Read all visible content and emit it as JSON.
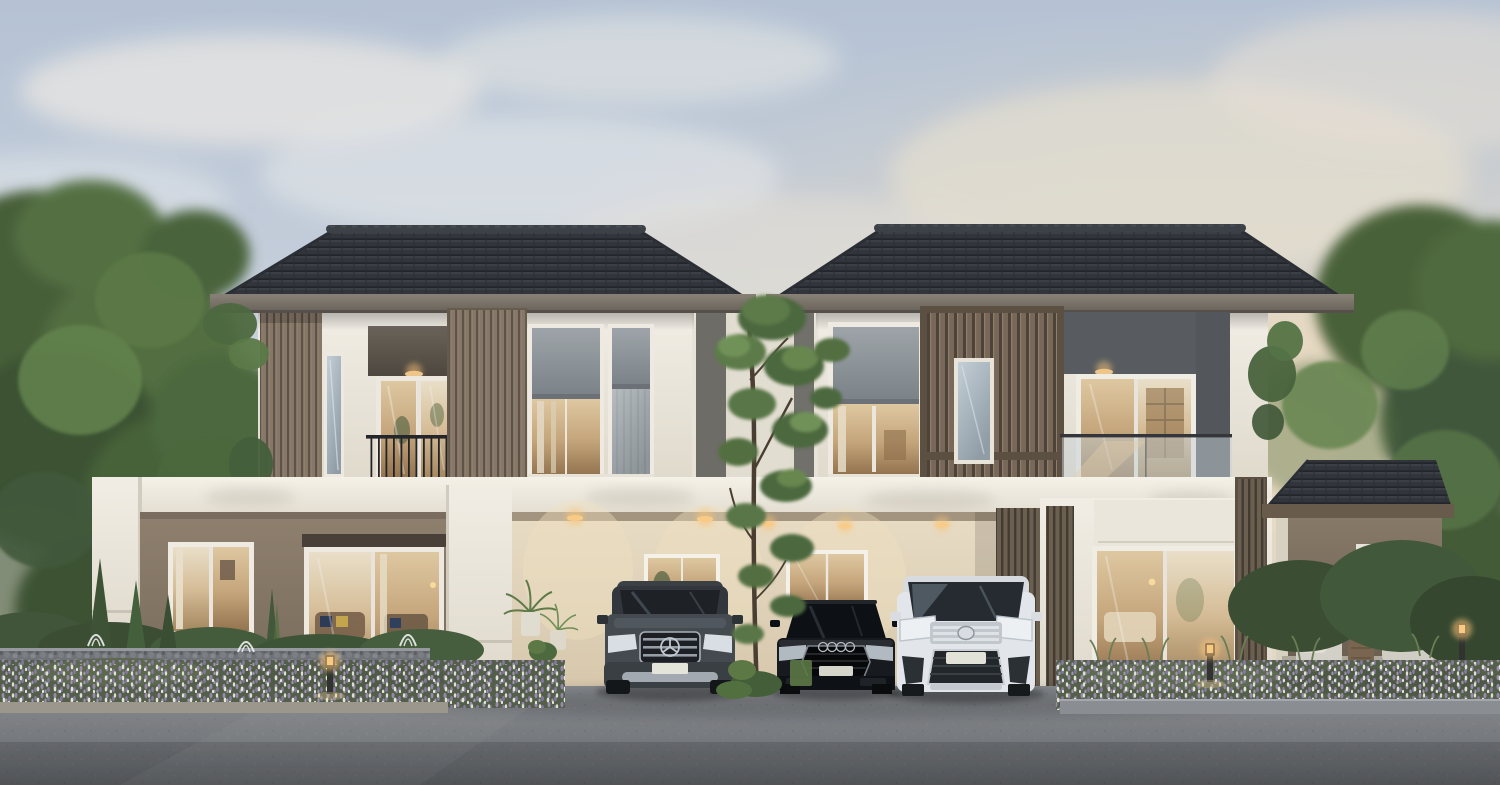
{
  "scene": {
    "type": "architectural-rendering",
    "subject": "modern two-storey twin duplex house (two mirrored units) at dusk",
    "setting": "front elevation view with landscaped garden, driveway and three parked cars",
    "time_of_day": "dusk with warm interior and accent lighting",
    "weather": "soft clouds, warm sunset glow on right side of sky"
  },
  "palette": {
    "sky-top": "#bac7d8",
    "sky-mid": "#cfd6e0",
    "sky-warm": "#e9dcc4",
    "cloud-white": "#f1eee8",
    "cloud-warm": "#f2e3c9",
    "roof-tile": "#33363b",
    "roof-ridge": "#3d4147",
    "fascia": "#8d8478",
    "wall-white": "#f8f3ea",
    "wall-cream": "#eee0c8",
    "wall-taupe": "#93826f",
    "wall-dark-header": "#6c645a",
    "slat-wood": "#8a7968",
    "slat-groove": "#60544a",
    "blind-gray": "#9aa0a4",
    "glass-cool": "#c7d2d8",
    "glass-warm": "#caa87c",
    "railing-black": "#26262a",
    "asphalt": "#7b7d80",
    "foliage-dark": "#43563a",
    "foliage-mid": "#5d7b49",
    "foliage-light": "#739558",
    "lavender": "#9b8cae",
    "flower-white": "#e9ecdb",
    "downlight-glow": "#ffd89b",
    "car-suv-gray": "#474b50",
    "car-sedan-black": "#17191c",
    "car-van-white": "#e9ecef"
  },
  "buildings": {
    "left_house": {
      "name": "left duplex unit",
      "roof": "dark charcoal hipped tile roof with wide eaves",
      "upper_floor": [
        "vertical wood-slat feature column",
        "narrow slot window",
        "recessed balcony with black metal railing and glass sliding door",
        "wide wood-slat panel",
        "two windows with half-closed gray roller blinds and warm interior light"
      ],
      "ground_floor": [
        "white flat-roof wing",
        "taupe feature wall",
        "framed window with curtains",
        "large sliding glass door showing lit living room with sofa and patterned pillows"
      ]
    },
    "right_house": {
      "name": "right duplex unit",
      "roof": "dark charcoal hipped tile roof with wide eaves",
      "upper_floor": [
        "window with gray roller blind and warm interior",
        "large bronze-framed vertical slat screen with central slot window",
        "recessed balcony with frameless glass railing and glass door with bookshelf view",
        "dark gray accent wall"
      ],
      "ground_floor": [
        "dark slat columns",
        "tall sliding glass door with white roller blind and warm bedroom interior",
        "single-storey annex with hipped roof, taupe wall, window and patio with two wicker lounge chairs and drum side table"
      ]
    },
    "carport": {
      "name": "shared central carport",
      "features": [
        "cream rear wall washed by recessed warm downlights",
        "two back windows with interior glow",
        "dark slat partition wall",
        "white canopy band across facade"
      ]
    }
  },
  "vehicles": [
    {
      "name": "mercedes-suv",
      "description": "dark gray luxury SUV with chrome louvre grille and three-pointed-star emblem",
      "color": "#474b50",
      "position": "left carport bay"
    },
    {
      "name": "audi-sedan",
      "description": "black sedan with wide hexagonal grille and four-ring emblem",
      "color": "#17191c",
      "position": "center carport bay"
    },
    {
      "name": "toyota-van",
      "description": "white luxury MPV van with layered chrome grille and slim headlights",
      "color": "#e9ecef",
      "position": "right carport bay"
    }
  ],
  "landscape": {
    "trees": [
      "large leafy trees flanking both sides",
      "slender ornamental tree centered between the two units"
    ],
    "garden": [
      "lavender and white flower beds along the street edge",
      "gabion stone retaining wall with small fountain jets on the left",
      "clipped hedges and conical shrubs",
      "potted palms beside carport",
      "ornamental grasses on the right"
    ],
    "hardscape": [
      "gray asphalt driveway and road",
      "stone curb strips"
    ]
  },
  "lighting": {
    "downlights": "warm recessed ceiling spots under balcony soffits and carport canopy",
    "bollards": "three glowing garden bollard lights among the flower beds",
    "interiors": "warm lamplight visible through every glazed opening"
  }
}
